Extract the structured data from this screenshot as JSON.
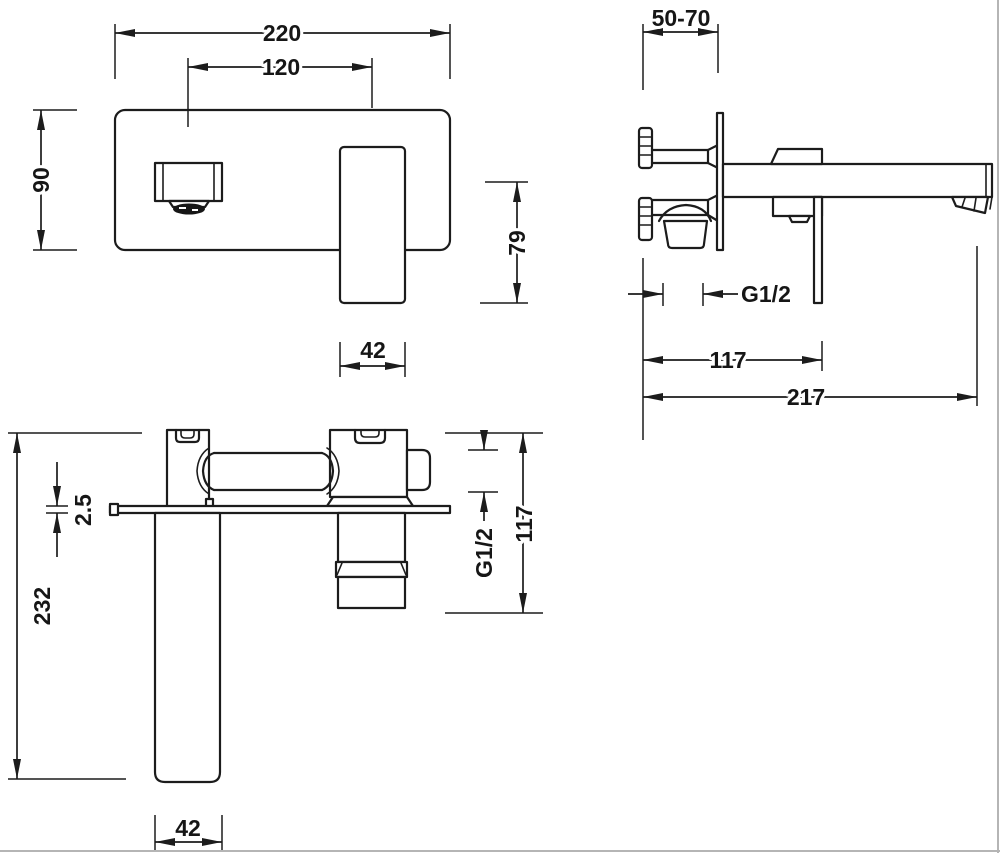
{
  "drawing_type": "technical-dimension-drawing",
  "colors": {
    "line": "#1c1c1c",
    "background": "#ffffff",
    "scan_edge": "#b5b5b5"
  },
  "dims": {
    "front": {
      "width": "220",
      "spout_to_handle": "120",
      "height": "90",
      "handle_width": "42",
      "outlet_to_handle_tip": "79"
    },
    "side": {
      "embed_depth": "50-70",
      "thread": "G1/2",
      "handle_offset": "117",
      "spout_reach": "217"
    },
    "top": {
      "spout_length": "232",
      "plate_thickness": "2.5",
      "spout_width": "42",
      "thread": "G1/2",
      "body_span": "117"
    }
  }
}
